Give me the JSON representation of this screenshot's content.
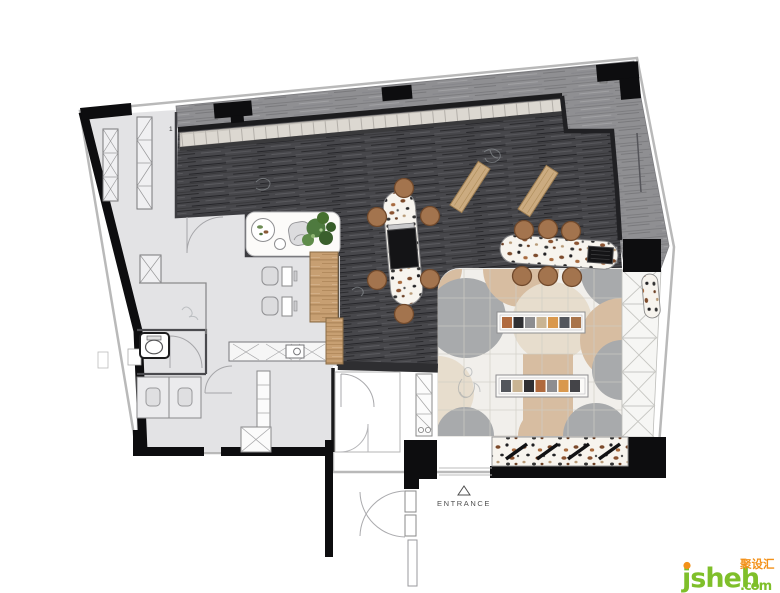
{
  "labels": {
    "entrance": "ENTRANCE",
    "unit_number": "1"
  },
  "watermark": {
    "brand": "jsheh",
    "suffix": ".com",
    "chinese": "聚设汇",
    "brand_color": "#7fbf2a",
    "accent_color": "#f39119"
  },
  "colors": {
    "wall": "#0d0d0f",
    "partition": "#2e2e31",
    "dark_wood_floor": "#47474b",
    "terrace_wood": "#8f8f92",
    "office_floor": "#e3e3e5",
    "skylight": "#dcd8d1",
    "tile_base": "#f1efeb",
    "tile_tan": "#d7bda1",
    "tile_gray": "#a8aaac",
    "tile_beige": "#e7ddcd",
    "marble": "#f6f6f4",
    "terrazzo_base": "#f7f4ee",
    "wood_counter": "#c79f72",
    "bench_wood": "#cbab80",
    "stool": "#a3744e",
    "stool_rim": "#70492c",
    "plant": "#4e7a3f",
    "chair_gray": "#dcdcde",
    "counter_white": "#fcfbf9",
    "outline": "#b9b9b9",
    "sketch": "#9aa0a4",
    "text": "#4f4f4f"
  }
}
